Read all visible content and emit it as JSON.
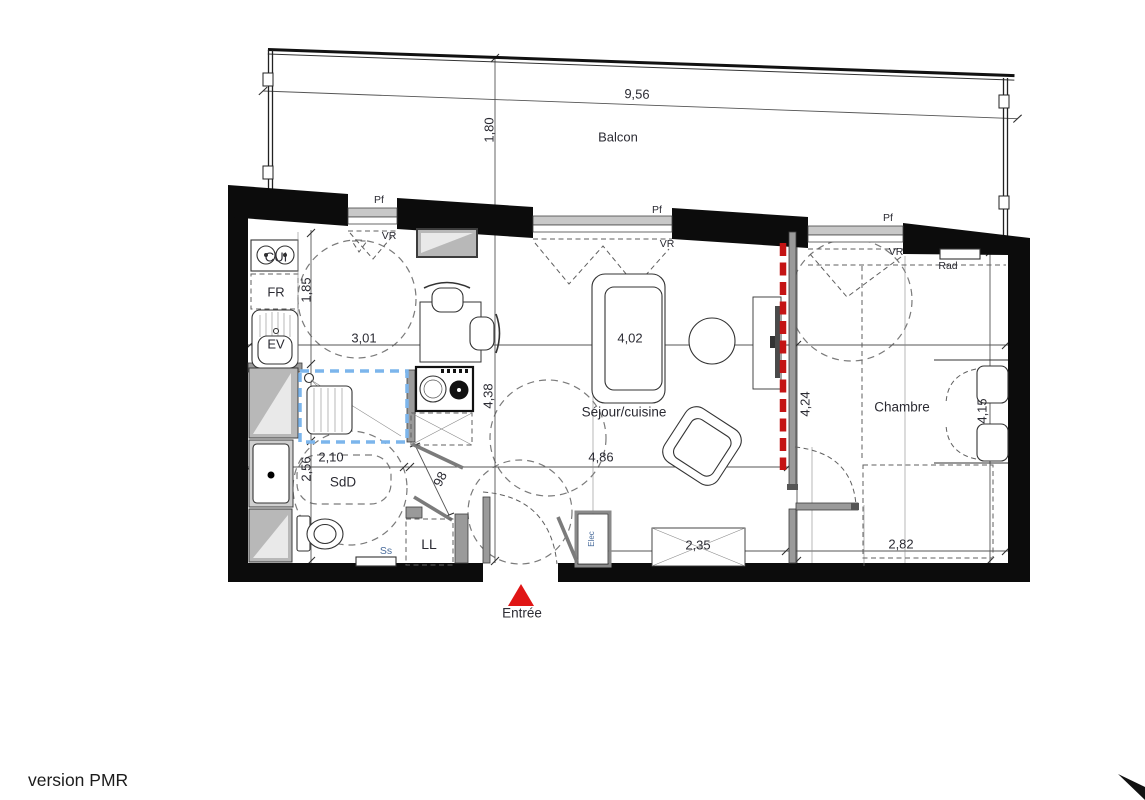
{
  "footer": {
    "version_label": "version PMR"
  },
  "balcony": {
    "label": "Balcon",
    "dim_width": "9,56",
    "dim_depth": "1,80"
  },
  "windows": {
    "w1": {
      "type": "Pf",
      "shutter": "VR"
    },
    "w2": {
      "type": "Pf",
      "shutter": "VR"
    },
    "w3": {
      "type": "Pf",
      "shutter": "VR"
    }
  },
  "rooms": {
    "kitchen": {
      "cooktop": "CUI",
      "fridge": "FR",
      "sink": "EV",
      "dim_width": "3,01",
      "dim_depth": "1,85"
    },
    "living": {
      "label": "Séjour/cuisine",
      "dim_width": "4,02",
      "dim_length": "4,86",
      "dim_depth": "4,38",
      "dim_partition": "4,24",
      "wardrobe_dim": "2,35"
    },
    "bedroom": {
      "label": "Chambre",
      "dim_depth": "4,15",
      "dim_width": "2,82",
      "radiator": "Rad"
    },
    "bathroom": {
      "label": "SdD",
      "dim_width": "2,10",
      "dim_depth": "2,56",
      "door_width": "98",
      "towel_rail": "Ss"
    }
  },
  "fixtures": {
    "washing_machine": "LL",
    "electrical_panel": "Elec"
  },
  "entrance": {
    "label": "Entrée"
  }
}
